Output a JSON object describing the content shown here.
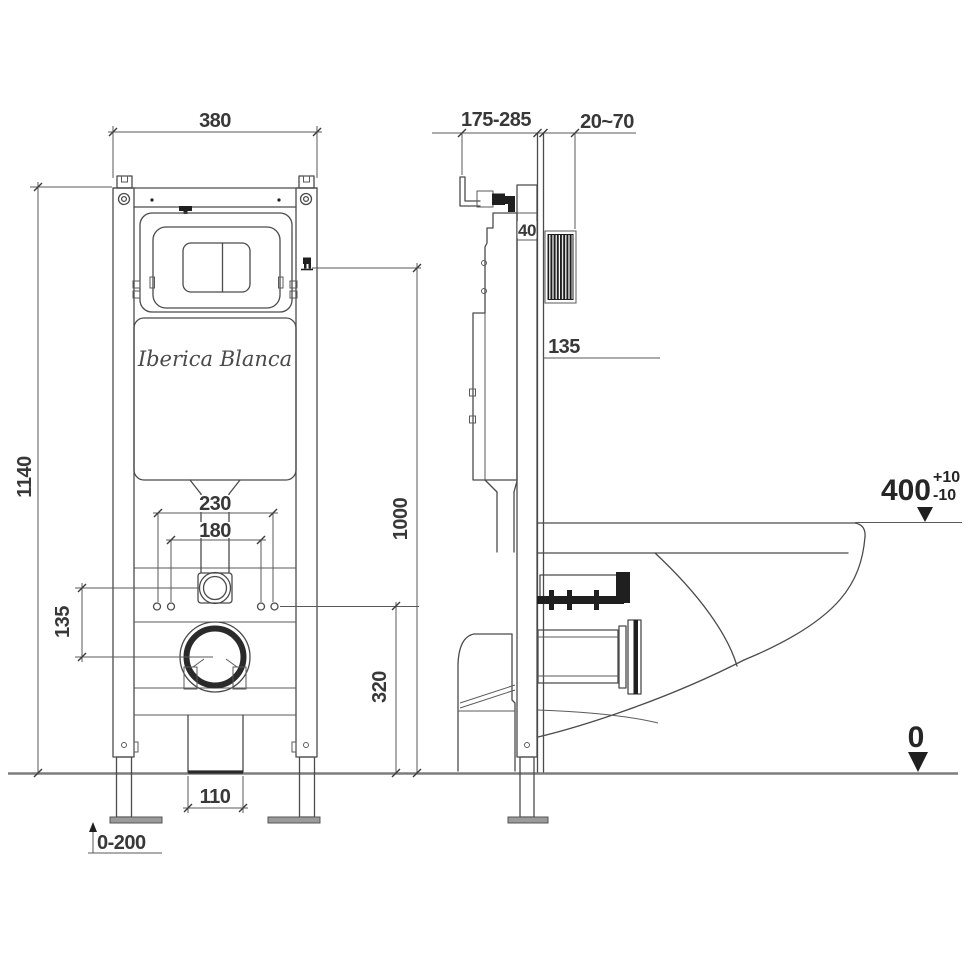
{
  "brand": "Iberica Blanca",
  "front": {
    "width": "380",
    "height": "1140",
    "bolt_spacing_outer": "230",
    "bolt_spacing_inner": "180",
    "inlet_to_drain_offset": "135",
    "drain_outlet_width": "110",
    "foot_adjust_range": "0-200",
    "actuator_height": "1000",
    "fixing_height": "320"
  },
  "side": {
    "depth_range": "175-285",
    "plate_depth_range": "20~70",
    "rail_depth": "40",
    "offset": "135",
    "rim_height": "400",
    "rim_tol_plus": "+10",
    "rim_tol_minus": "-10",
    "floor_level": "0"
  },
  "colors": {
    "line": "#4b4b4b",
    "text": "#383838",
    "solid_fill": "#1f1f1f",
    "floor_line": "#7d7d7d",
    "foot_fill": "#9b9b9b",
    "background": "#ffffff"
  }
}
